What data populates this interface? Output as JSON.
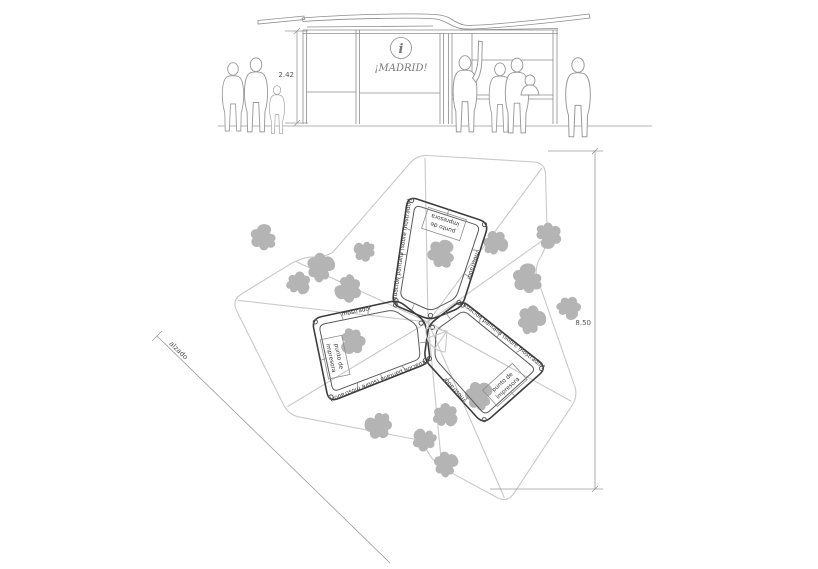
{
  "elevation": {
    "brand": "¡MADRID!",
    "info_symbol": "i",
    "height_dim": "2.42"
  },
  "plan": {
    "width_dim": "8.50",
    "section_label": "alzado",
    "counter_label": "mostrador",
    "printer_line1": "punto de",
    "printer_line2": "impresora",
    "screen_label": "situación pantalla (sobre mostrador)"
  },
  "colors": {
    "background": "#ffffff",
    "counter_line": "#3d3d3d",
    "light_roof_line": "#c9c9c9",
    "silhouette_gray": "#b4b4b4",
    "figure_outline": "#9a9a9a"
  }
}
